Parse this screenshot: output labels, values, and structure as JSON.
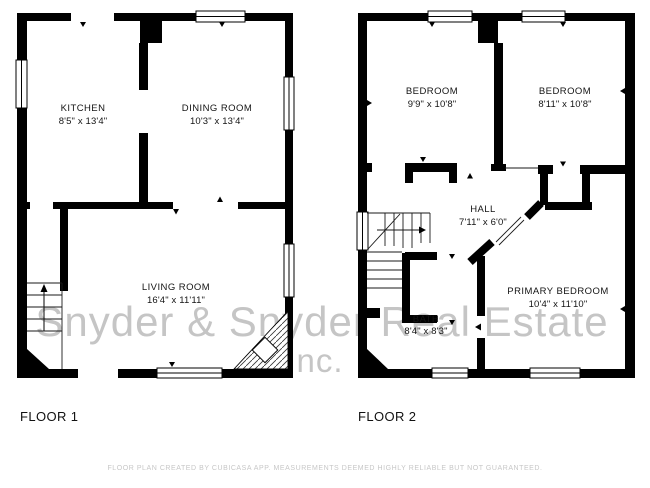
{
  "watermark": {
    "line1": "Snyder & Snyder Real Estate",
    "line2": "Inc."
  },
  "footer": {
    "disclaimer": "FLOOR PLAN CREATED BY CUBICASA APP. MEASUREMENTS DEEMED HIGHLY RELIABLE BUT NOT GUARANTEED."
  },
  "floor1": {
    "label": "FLOOR 1",
    "rooms": {
      "kitchen": {
        "name": "KITCHEN",
        "dims": "8'5\" x 13'4\""
      },
      "dining": {
        "name": "DINING ROOM",
        "dims": "10'3\" x 13'4\""
      },
      "living": {
        "name": "LIVING ROOM",
        "dims": "16'4\" x 11'11\""
      }
    }
  },
  "floor2": {
    "label": "FLOOR 2",
    "rooms": {
      "bedroom_left": {
        "name": "BEDROOM",
        "dims": "9'9\" x 10'8\""
      },
      "bedroom_right": {
        "name": "BEDROOM",
        "dims": "8'11\" x 10'8\""
      },
      "hall": {
        "name": "HALL",
        "dims": "7'11\" x 6'0\""
      },
      "bath": {
        "name": "BATH",
        "dims": "8'4\" x 8'3\""
      },
      "primary": {
        "name": "PRIMARY BEDROOM",
        "dims": "10'4\" x 11'10\""
      }
    }
  },
  "colors": {
    "wall": "#000000",
    "watermark": "#c5c5c5",
    "footer": "#c7c7c7",
    "label": "#141414"
  }
}
